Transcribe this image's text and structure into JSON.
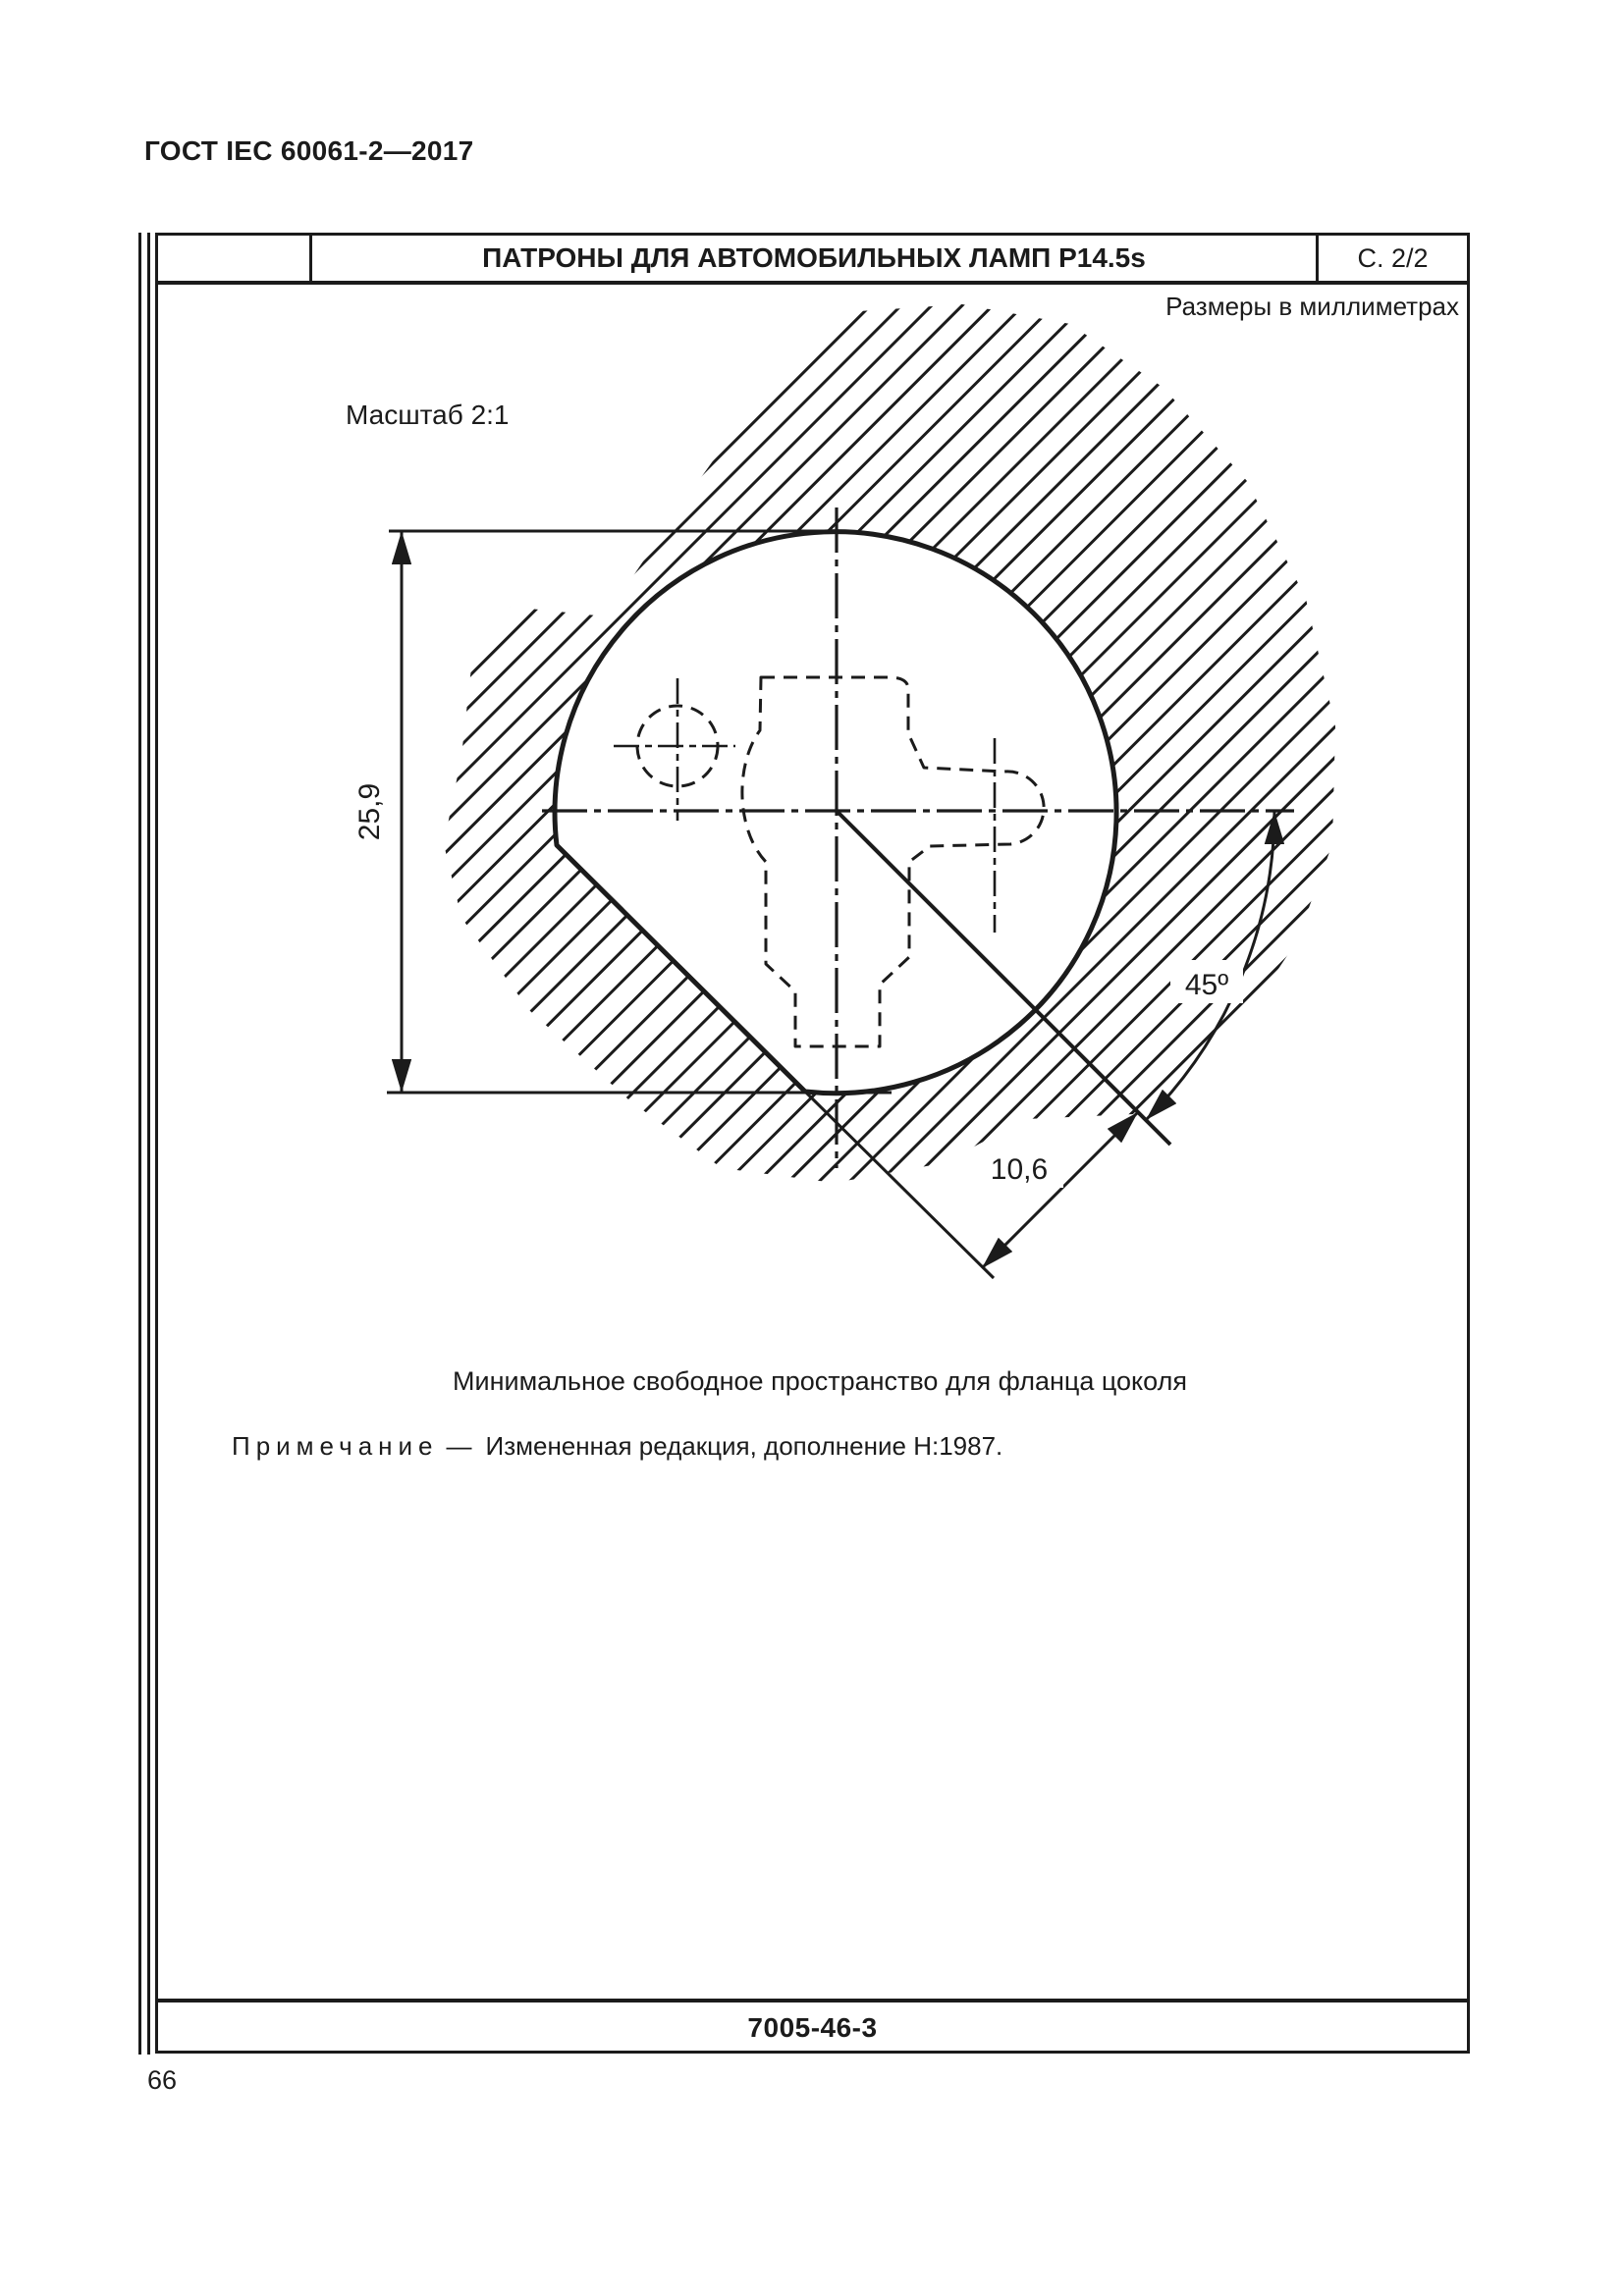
{
  "page": {
    "standard_ref": "ГОСТ IEC 60061-2—2017",
    "page_number": "66"
  },
  "sheet": {
    "title": "ПАТРОНЫ ДЛЯ АВТОМОБИЛЬНЫХ ЛАМП P14.5s",
    "sheet_no": "С. 2/2",
    "units_note": "Размеры в миллиметрах",
    "scale_label": "Масштаб 2:1",
    "caption": "Минимальное свободное пространство для фланца цоколя",
    "note_label": "Примечание",
    "note_dash": "—",
    "note_text": "Измененная редакция, дополнение Н:1987.",
    "drawing_code": "7005-46-3"
  },
  "drawing": {
    "dim_height_mm": "25,9",
    "dim_flat_offset_mm": "10,6",
    "dim_angle": "45º"
  }
}
